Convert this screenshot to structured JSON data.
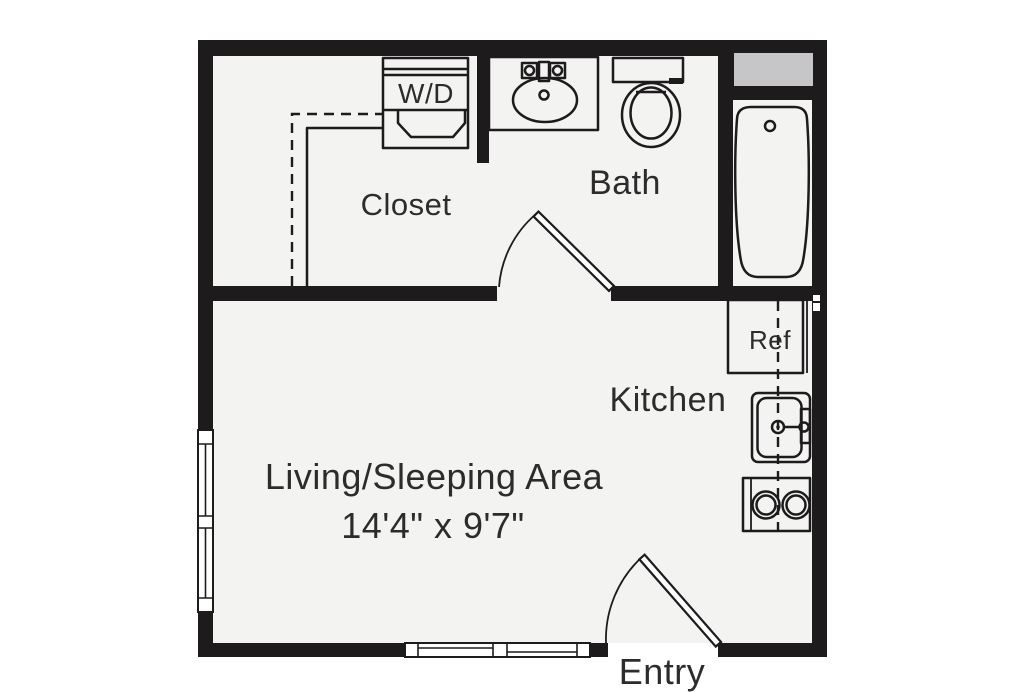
{
  "colors": {
    "wall": "#1d1b1c",
    "line": "#1d1b1c",
    "floor": "#f3f3f2",
    "background": "#ffffff",
    "chase": "#c6c6c9",
    "text": "#2d2b2c"
  },
  "floor_plan": {
    "rooms": {
      "closet": {
        "label": "Closet"
      },
      "bath": {
        "label": "Bath"
      },
      "kitchen": {
        "label": "Kitchen"
      },
      "living": {
        "label": "Living/Sleeping Area",
        "dimensions": "14'4\" x 9'7\""
      },
      "entry": {
        "label": "Entry"
      }
    },
    "fixtures": {
      "washer_dryer": {
        "label": "W/D"
      },
      "refrigerator": {
        "label": "Ref"
      }
    }
  }
}
